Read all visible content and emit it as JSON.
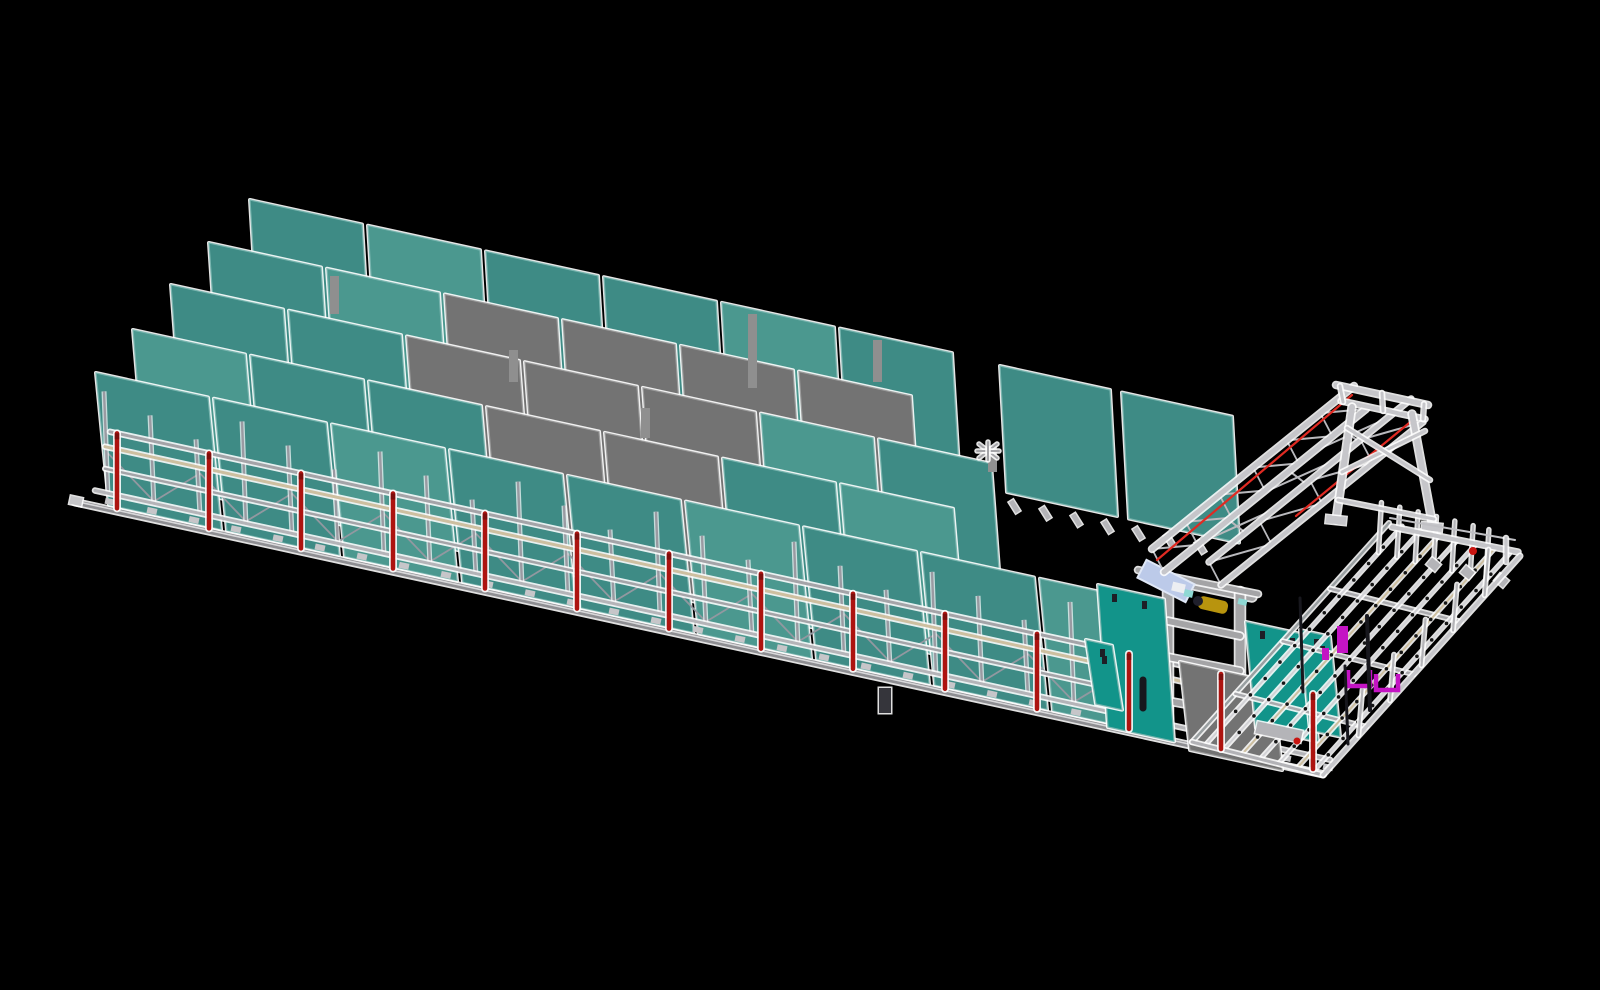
{
  "canvas": {
    "width": 1600,
    "height": 990,
    "background": "#000000"
  },
  "colors": {
    "teal": "#3E8B85",
    "teal_light": "#4B988F",
    "teal_bright": "#12948A",
    "teal_edge": "#79B5AF",
    "gray_panel": "#737373",
    "gray_panel2": "#7F7F7F",
    "gray_edge": "#9C9C9C",
    "metal": "#B4B4B8",
    "metal_mid": "#A4A4A8",
    "metal_dark": "#8E8E92",
    "metal_light": "#D8D8DA",
    "frame": "#A4A4A6",
    "truss": "#C6C6CA",
    "tan": "#CDBFA0",
    "red": "#AD1410",
    "red_bright": "#E02A22",
    "red_dot": "#C81410",
    "yellow": "#B8940E",
    "yellow_dark": "#20202C",
    "cabinet_blue": "#BCCAE9",
    "cabinet_blue_hi": "#E0E8F7",
    "cyan": "#8FD8D4",
    "white_part": "#ECEEF2",
    "magenta": "#C414C4",
    "green": "#1AA61A",
    "dot_dark": "#151515",
    "glow": "#FFFFFF",
    "dark": "#17171D",
    "device": "#35353B",
    "rear_post": "#8F8F8F"
  },
  "axes": {
    "track_slope": 0.218,
    "floor_x0": 88,
    "floor_y0": 505,
    "floor_x1": 1323
  },
  "storage": {
    "panel_width": 112,
    "panel_pitch": 118,
    "panel_lean": 13,
    "rows": [
      {
        "name": "row-back",
        "x0": 250,
        "y_top": 200,
        "height": 212,
        "slots": [
          "T",
          "L",
          "T",
          "T",
          "L",
          "T"
        ]
      },
      {
        "name": "row-back-right",
        "x0": 1000,
        "y_top": 366,
        "height": 126,
        "width": 110,
        "pitch": 122,
        "lean": 7,
        "slots": [
          "T",
          "T"
        ]
      },
      {
        "name": "row-4",
        "x0": 209,
        "y_top": 243,
        "height": 192,
        "slots": [
          "T",
          "L",
          "G",
          "G",
          "G",
          "G"
        ]
      },
      {
        "name": "row-3",
        "x0": 171,
        "y_top": 285,
        "height": 172,
        "slots": [
          "T",
          "T",
          "G",
          "G",
          "G",
          "L",
          "T"
        ]
      },
      {
        "name": "row-2",
        "x0": 133,
        "y_top": 330,
        "height": 152,
        "slots": [
          "L",
          "T",
          "T",
          "G",
          "G",
          "T",
          "L"
        ]
      },
      {
        "name": "row-front",
        "x0": 96,
        "y_top": 373,
        "height": 132,
        "slots": [
          "T",
          "T",
          "L",
          "T",
          "T",
          "L",
          "T",
          "T",
          "L"
        ]
      }
    ],
    "rear_posts": [
      [
        330,
        276,
        38
      ],
      [
        748,
        314,
        74
      ],
      [
        873,
        340,
        42
      ],
      [
        509,
        350,
        32
      ],
      [
        641,
        408,
        30
      ],
      [
        988,
        446,
        26
      ]
    ],
    "cross_bracket": [
      988,
      451
    ],
    "right_row_feet": {
      "x0": 1012,
      "y0": 500,
      "count": 7,
      "pitch": 31
    }
  },
  "rack": {
    "x0": 108,
    "x1": 1210,
    "post_pitch": 46,
    "post_h": 104,
    "rails": [
      {
        "name": "floor-rail",
        "dy": 0,
        "color": "metal_dark",
        "width": 5,
        "x0": 75,
        "x1": 1323,
        "core": true
      },
      {
        "name": "feet-rail",
        "dy": 16,
        "color": "metal",
        "width": 3,
        "x0": 95,
        "x1": 1330,
        "feet": true
      },
      {
        "name": "mid-rail",
        "dy": 40,
        "color": "metal_mid",
        "width": 2.5,
        "x0": 105,
        "x1": 1200
      },
      {
        "name": "tan-rail",
        "dy": 62,
        "color": "tan",
        "width": 3,
        "x0": 105,
        "x1": 1325
      },
      {
        "name": "top-rail",
        "dy": 78,
        "color": "metal_mid",
        "width": 3,
        "x0": 110,
        "x1": 1320
      }
    ],
    "feet_pitch": 42,
    "zig_lo": 18,
    "zig_hi": 56
  },
  "red_posts": {
    "x0": 117,
    "pitch": 92,
    "count": 14,
    "height": 78,
    "width": 4.5
  },
  "devices": [
    [
      879,
      688
    ],
    [
      1140,
      680
    ]
  ],
  "machine": {
    "frame_lines": [
      [
        1160,
        578,
        1252,
        597,
        8
      ],
      [
        1168,
        580,
        1168,
        727,
        9
      ],
      [
        1240,
        592,
        1240,
        735,
        9
      ],
      [
        1168,
        621,
        1240,
        636,
        6
      ],
      [
        1168,
        657,
        1240,
        671,
        6
      ],
      [
        1168,
        701,
        1240,
        714,
        6
      ],
      [
        1138,
        570,
        1258,
        594,
        5
      ]
    ],
    "panel_lean": 10,
    "panels": [
      {
        "x": 1098,
        "y": 585,
        "w": 66,
        "h": 142,
        "c": "teal_bright"
      },
      {
        "x": 1086,
        "y": 640,
        "w": 26,
        "h": 64,
        "c": "teal_bright"
      },
      {
        "x": 1180,
        "y": 662,
        "w": 92,
        "h": 88,
        "c": "gray_panel"
      },
      {
        "x": 1252,
        "y": 656,
        "w": 44,
        "h": 70,
        "c": "gray_panel2"
      },
      {
        "x": 1246,
        "y": 622,
        "w": 62,
        "h": 106,
        "c": "teal_bright"
      },
      {
        "x": 1300,
        "y": 630,
        "w": 30,
        "h": 100,
        "c": "teal_bright"
      }
    ],
    "cabinet": {
      "cx": 1166,
      "cy": 581,
      "w": 54,
      "h": 20,
      "angle": 27
    },
    "motor": {
      "cx": 1213,
      "cy": 605,
      "w": 30,
      "h": 13,
      "angle": 13,
      "cap": [
        1198,
        601,
        5
      ]
    },
    "small_parts": [
      {
        "x": 1184,
        "y": 590,
        "w": 9,
        "h": 7,
        "c": "cyan"
      },
      {
        "x": 1238,
        "y": 599,
        "w": 9,
        "h": 6,
        "c": "cyan"
      },
      {
        "x": 1172,
        "y": 583,
        "w": 13,
        "h": 9,
        "c": "white_part"
      }
    ],
    "dark_pins": [
      [
        1300,
        598,
        1303,
        692,
        3
      ],
      [
        1367,
        616,
        1370,
        710,
        4
      ],
      [
        1345,
        666,
        1348,
        744,
        3
      ],
      [
        1143,
        680,
        1143,
        708,
        7
      ]
    ],
    "conveyor": {
      "x": 1256,
      "y": 726,
      "w": 46,
      "h": 12,
      "angle": 12,
      "dot": [
        1297,
        741
      ]
    }
  },
  "gantry": {
    "chords": [
      [
        1152,
        549,
        1354,
        386,
        5
      ],
      [
        1164,
        572,
        1366,
        409,
        5
      ],
      [
        1209,
        562,
        1411,
        399,
        4
      ],
      [
        1221,
        585,
        1423,
        422,
        4
      ]
    ],
    "beam_pairs": [
      [
        0,
        1,
        6
      ],
      [
        2,
        3,
        4
      ]
    ],
    "cross_braces": [
      [
        0.18,
        0.32
      ],
      [
        0.48,
        0.62
      ],
      [
        0.74,
        0.88
      ]
    ],
    "red_lines": [
      [
        1157,
        560,
        1352,
        395
      ],
      [
        1296,
        516,
        1414,
        419
      ]
    ]
  },
  "trestle": {
    "lines": [
      [
        1336,
        385,
        1428,
        405,
        5
      ],
      [
        1341,
        401,
        1425,
        419,
        4
      ],
      [
        1340,
        386,
        1343,
        402,
        3
      ],
      [
        1382,
        393,
        1383,
        411,
        3
      ],
      [
        1424,
        404,
        1423,
        419,
        3
      ],
      [
        1352,
        407,
        1336,
        520,
        6
      ],
      [
        1412,
        414,
        1433,
        527,
        6
      ],
      [
        1342,
        472,
        1425,
        431,
        3
      ],
      [
        1347,
        428,
        1430,
        480,
        3
      ],
      [
        1338,
        500,
        1434,
        519,
        3
      ]
    ],
    "feet": [
      [
        1326,
        516
      ],
      [
        1422,
        523
      ]
    ]
  },
  "table": {
    "corners": {
      "A": [
        1192,
        742
      ],
      "B": [
        1323,
        775
      ],
      "C": [
        1520,
        556
      ],
      "D": [
        1389,
        523
      ]
    },
    "roller_s": [
      0.1,
      0.24,
      0.38,
      0.52,
      0.66,
      0.8,
      0.92
    ],
    "tan_rollers": [
      2,
      5
    ],
    "cross_t": [
      0.22,
      0.46,
      0.7
    ],
    "dc_rail": [
      1392,
      527,
      1518,
      552
    ],
    "dc_rail2": [
      1390,
      518,
      1515,
      540
    ],
    "dc_feet": [
      [
        1428,
        560
      ],
      [
        1462,
        568
      ],
      [
        1496,
        576
      ]
    ],
    "corner_post": [
      1506,
      538,
      1506,
      562
    ],
    "red_dot": [
      1473,
      551
    ],
    "bc_pin_t": [
      0.18,
      0.34,
      0.5,
      0.66,
      0.82
    ],
    "inner_pin_u": 0.88,
    "magenta": {
      "vrect": [
        1337,
        626,
        11,
        27
      ],
      "u1": [
        1348,
        670,
        22,
        16
      ],
      "u2": [
        1376,
        674,
        22,
        16
      ],
      "small": [
        1322,
        648,
        7,
        12
      ]
    }
  }
}
